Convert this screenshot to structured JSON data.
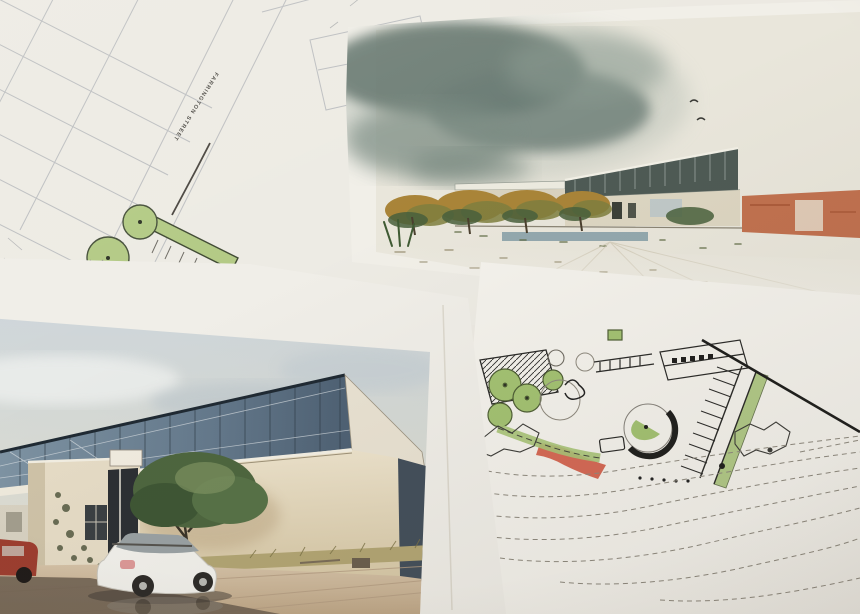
{
  "scene": {
    "type": "photograph",
    "subject": "Architectural site plans and renderings laid on a table"
  },
  "papers": {
    "survey": {
      "name": "site survey plan",
      "street_label": "FARRINGTON STREET"
    },
    "watercolor": {
      "name": "watercolor exterior rendering of a modern building"
    },
    "photo": {
      "name": "building exterior rendering with parked white wagon"
    },
    "sketch": {
      "name": "hand-drawn landscape site plan with parking and contours"
    }
  },
  "palette": {
    "paper": "#f1efe8",
    "survey_line": "#b9bcbe",
    "ink": "#2a2a28",
    "pencil": "#8e897e",
    "landscape_green": "#a3c272",
    "survey_green": "#b3ca85",
    "accent_red": "#d25a45",
    "watercolor_cloud": "#60726b",
    "glass_blue": "#6f8496",
    "wall_cream": "#e6d9bd",
    "orange_wall": "#bd6743",
    "tree_green": "#4d663f",
    "pavement_tan": "#cdb697",
    "shadow_brown": "#6e6152",
    "car_white": "#f2f1ec",
    "car_red": "#9e3d2f"
  }
}
